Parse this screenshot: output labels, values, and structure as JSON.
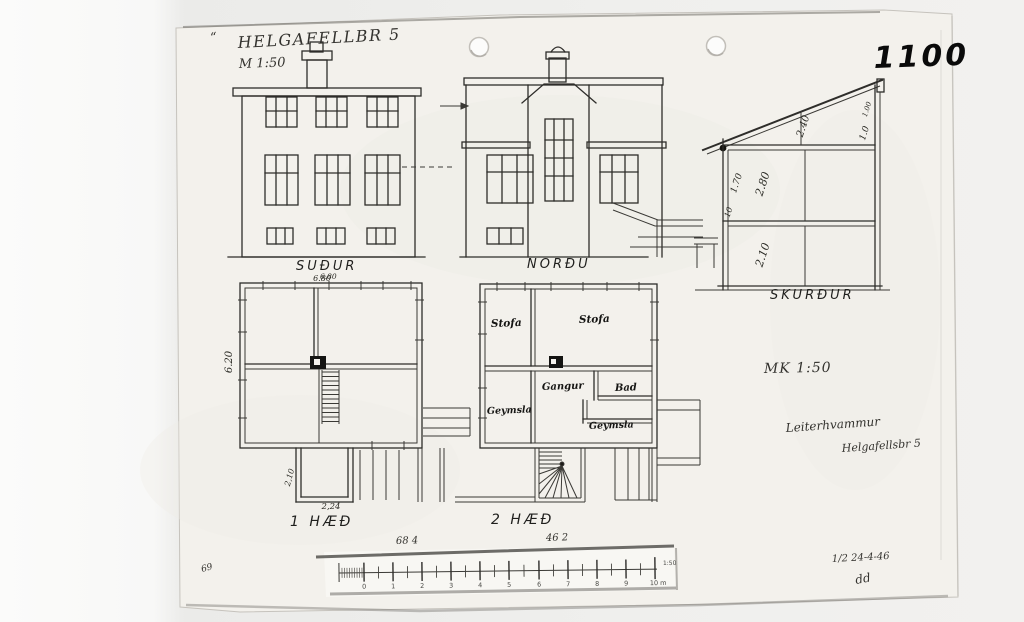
{
  "header": {
    "quote": "“",
    "title": "HELGAFELLBR 5",
    "scale": "M 1:50"
  },
  "stamp": {
    "number": "1100"
  },
  "elevations": {
    "south": {
      "label": "SUÐUR",
      "top_dim": "6.80"
    },
    "north": {
      "label": "NORÐU"
    },
    "section": {
      "label": "SKURÐUR",
      "attic_dim": "2.40",
      "attic_small": "1.00",
      "attic_side": "1.0",
      "floor_dim_a": "1.70",
      "floor_dim_b": "2.80",
      "floor_dim_c": "10",
      "basement_dim": "2.10"
    }
  },
  "plans": {
    "floor1": {
      "label": "1 HÆÐ",
      "width_dim": "6.80",
      "height_dim": "6.20",
      "porch_h": "2,10",
      "porch_w": "2,24"
    },
    "floor2": {
      "label": "2 HÆÐ",
      "stofa1": "Stofa",
      "stofa2": "Stofa",
      "gangur": "Gangur",
      "bad": "Bad",
      "geymsla1": "Geymsla",
      "geymsla2": "Geymsla"
    }
  },
  "annotations": {
    "mk": "MK 1:50",
    "house_name": "Leiterhvammur",
    "address": "Helgafellsbr 5",
    "date": "1/2  24-4-46",
    "initials": "dd",
    "pencil_a": "68   4",
    "pencil_b": "46  2",
    "corner": "69"
  },
  "scalebar": {
    "ticks": [
      "0",
      "1",
      "2",
      "3",
      "4",
      "5",
      "6",
      "7",
      "8",
      "9",
      "10 m"
    ],
    "ratio": "1:50"
  }
}
